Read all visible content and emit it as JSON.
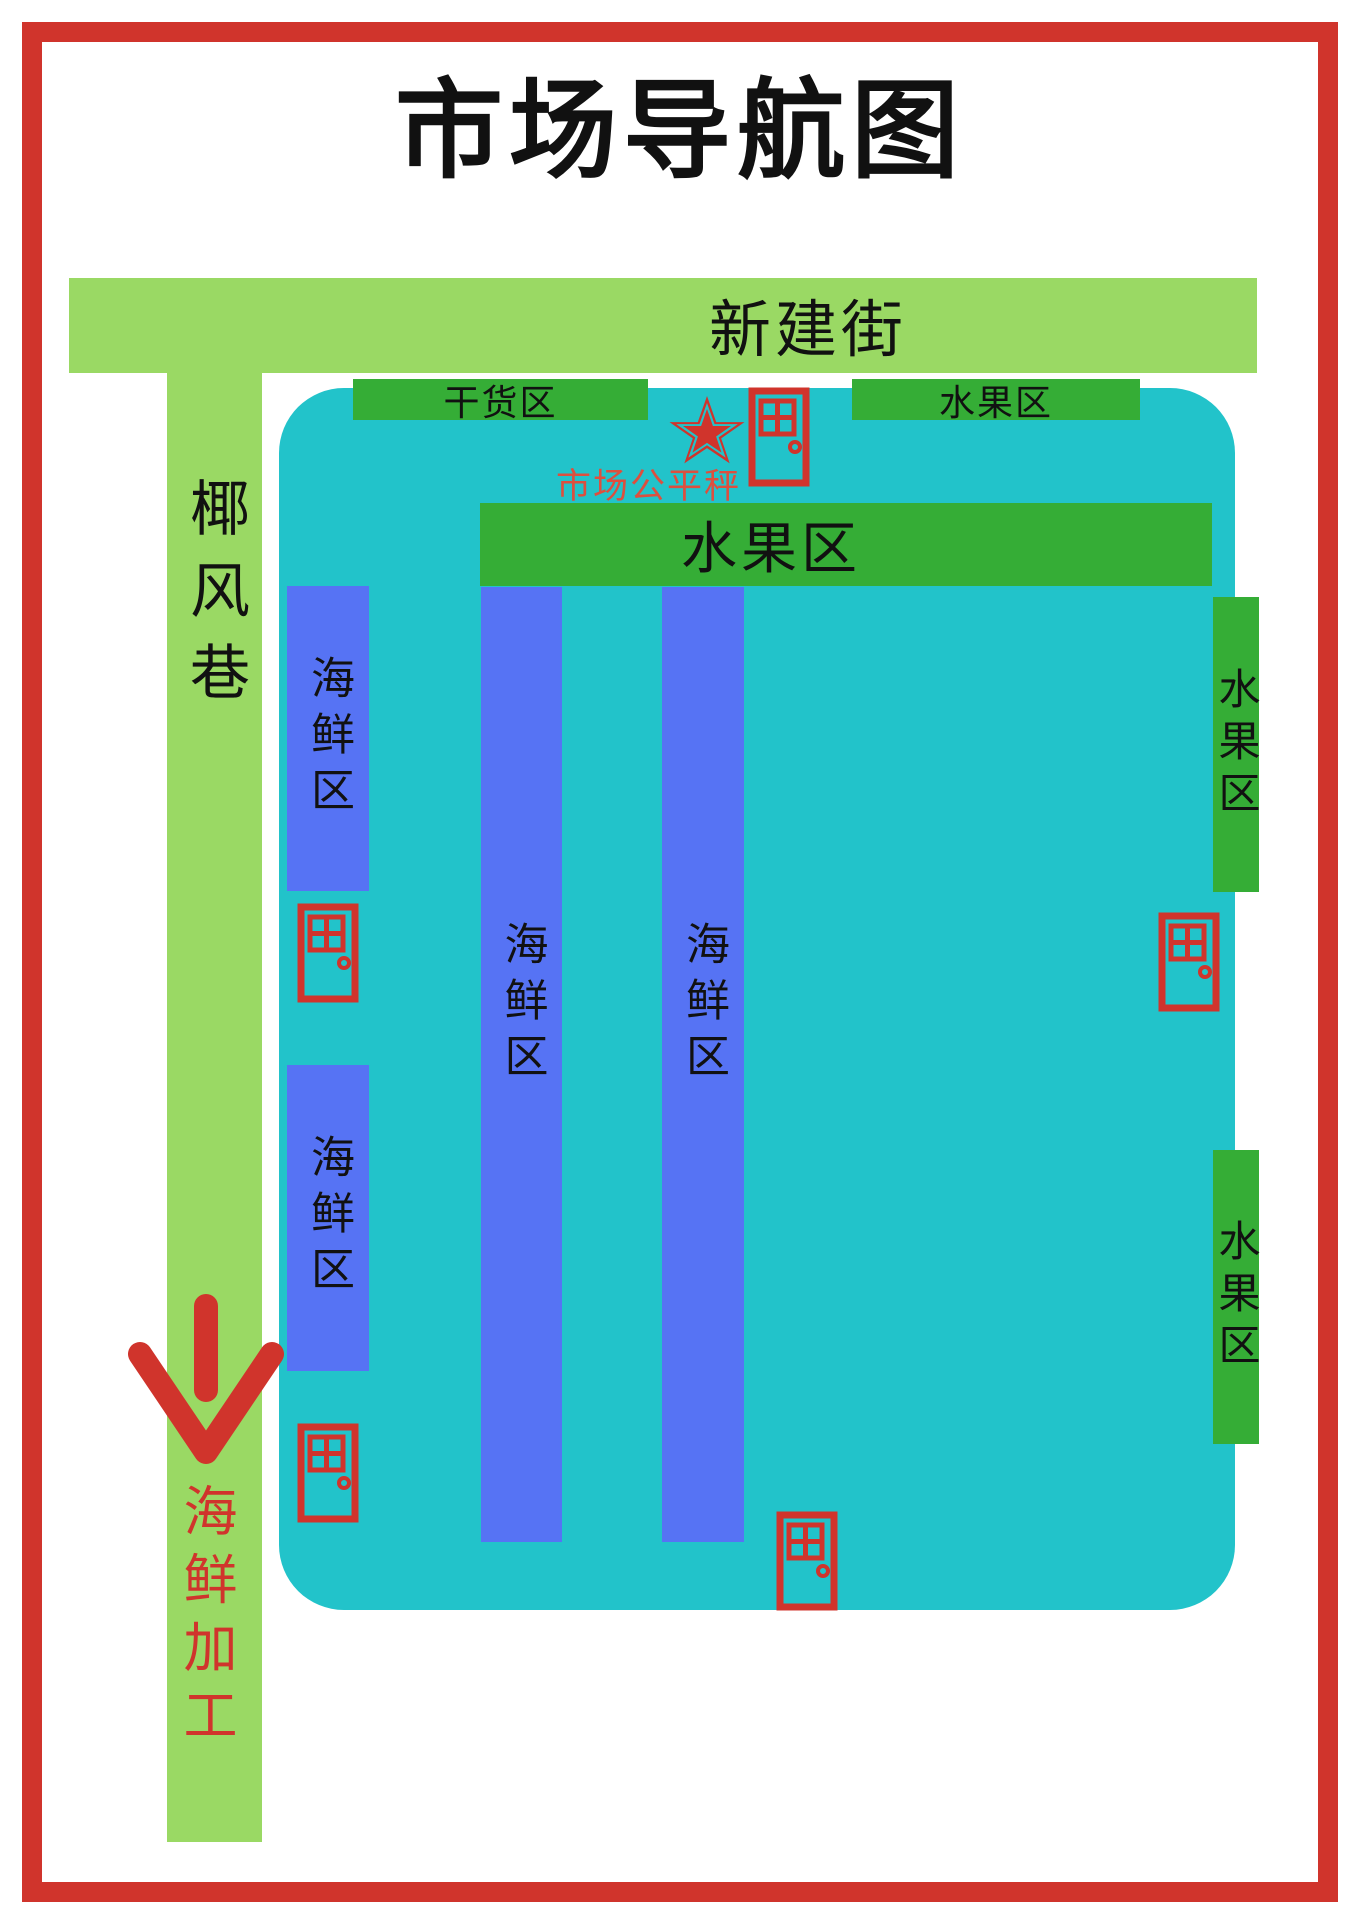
{
  "title": "市场导航图",
  "streets": {
    "top": "新建街",
    "left": "椰风巷"
  },
  "zones": {
    "dry_goods": "干货区",
    "fruit_top": "水果区",
    "fruit_main": "水果区",
    "fruit_right_upper": "水果区",
    "fruit_right_lower": "水果区",
    "seafood_left_upper": "海鲜区",
    "seafood_left_lower": "海鲜区",
    "seafood_mid_left": "海鲜区",
    "seafood_mid_right": "海鲜区"
  },
  "landmarks": {
    "fair_scale": "市场公平秤",
    "seafood_processing": "海鲜加工"
  },
  "icons": {
    "star": "star-icon",
    "door": "door-icon",
    "door_count": 5,
    "arrow": "down-arrow-icon"
  },
  "colors": {
    "road_green": "#9ad964",
    "zone_green": "#35ad36",
    "building_teal": "#22c3ca",
    "seafood_blue": "#5673f4",
    "accent_red": "#d0342c",
    "label_red": "#dd4f3e",
    "text_black": "#111111",
    "page_bg": "#ffffff"
  }
}
